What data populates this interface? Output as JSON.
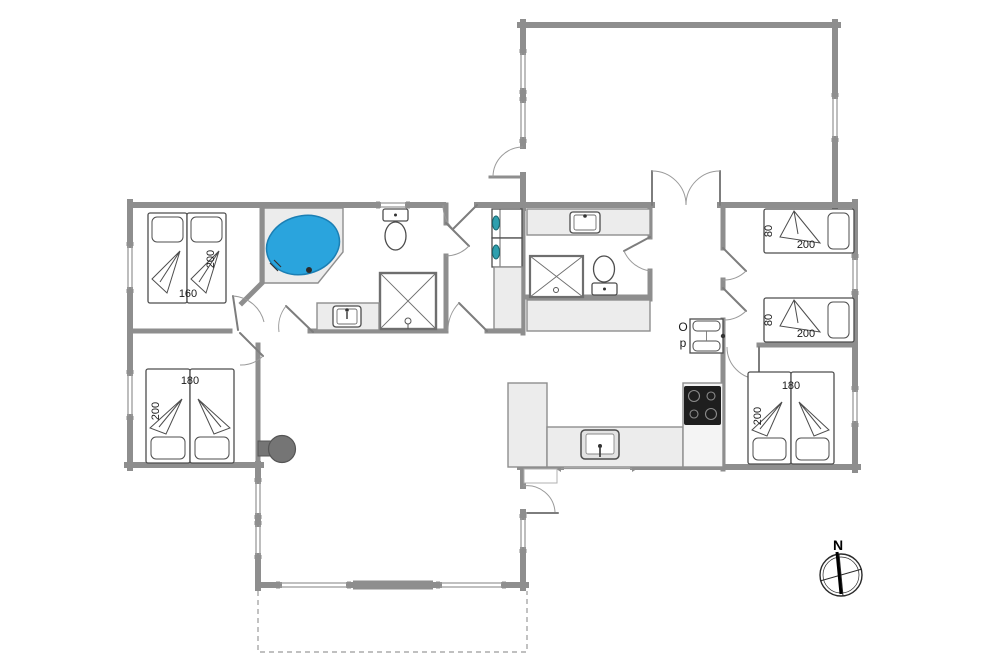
{
  "floorplan": {
    "compass": {
      "north_label": "N"
    },
    "annotations": {
      "op_label_line1": "O",
      "op_label_line2": "p"
    },
    "beds": {
      "double_top_left": {
        "width_label": "160",
        "length_label": "200"
      },
      "double_bottom_left": {
        "width_label": "180",
        "length_label": "200"
      },
      "single_right_upper": {
        "width_label": "80",
        "length_label": "200"
      },
      "single_right_lower": {
        "width_label": "80",
        "length_label": "200"
      },
      "double_bottom_right": {
        "width_label": "180",
        "length_label": "200"
      }
    },
    "colors": {
      "bathtub": "#2aa4dd",
      "appliance_door": "#2e9fae",
      "cooktop": "#1e1e1e",
      "wood_stove": "#757575"
    }
  }
}
